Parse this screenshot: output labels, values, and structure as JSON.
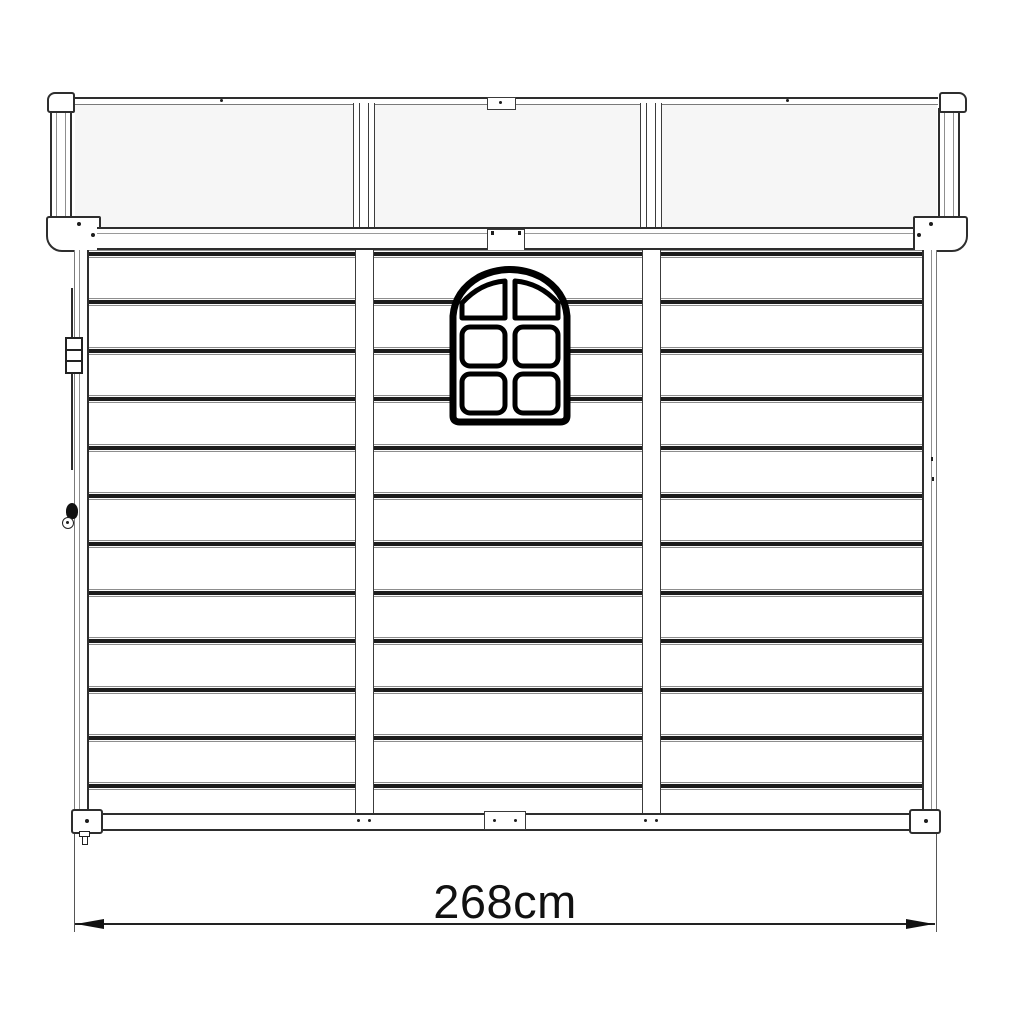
{
  "diagram": {
    "title": "shed-side-elevation-line-drawing",
    "dimension": {
      "label": "268cm",
      "value": 268,
      "unit": "cm"
    },
    "structure": {
      "roof_skylight_panels": 3,
      "wall_panels": 3,
      "plank_bands": 12,
      "window_pane_grid": "2x3",
      "window_pane_count": 6
    },
    "bands": {
      "count": 12,
      "start_y": 250,
      "spacing": 48.4,
      "left_x": 89,
      "right_x": 922,
      "height": 8
    },
    "colors": {
      "line": "#2e2e2e",
      "line_light": "#8d8d8d",
      "plank_shadow": "#1c1c1c",
      "window_line": "#000000",
      "skylight_fill": "#f6f6f6",
      "background": "#ffffff"
    }
  }
}
